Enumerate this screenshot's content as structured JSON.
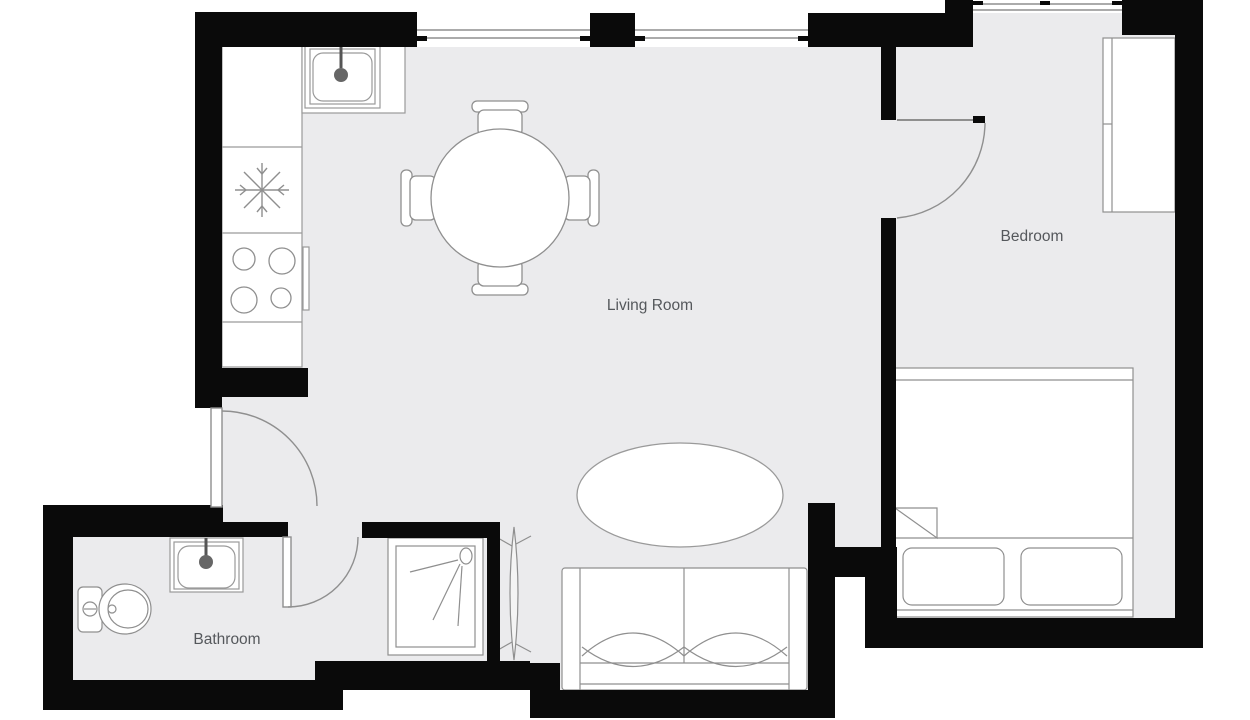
{
  "floor_plan": {
    "colors": {
      "background": "#ffffff",
      "floor": "#ebebed",
      "wall": "#0a0a0a",
      "outline": "#8f8f8f",
      "label_text": "#55585c",
      "faucet_dot": "#666666"
    },
    "rooms": [
      {
        "id": "living-room",
        "label": "Living Room"
      },
      {
        "id": "bedroom",
        "label": "Bedroom"
      },
      {
        "id": "bathroom",
        "label": "Bathroom"
      }
    ],
    "fixtures": [
      "kitchen-sink",
      "refrigerator",
      "stove",
      "oven-handle",
      "dining-table",
      "dining-chair",
      "sofa",
      "rug",
      "plant",
      "bed",
      "pillow",
      "wardrobe",
      "toilet",
      "bathroom-sink",
      "shower",
      "window",
      "door"
    ]
  }
}
